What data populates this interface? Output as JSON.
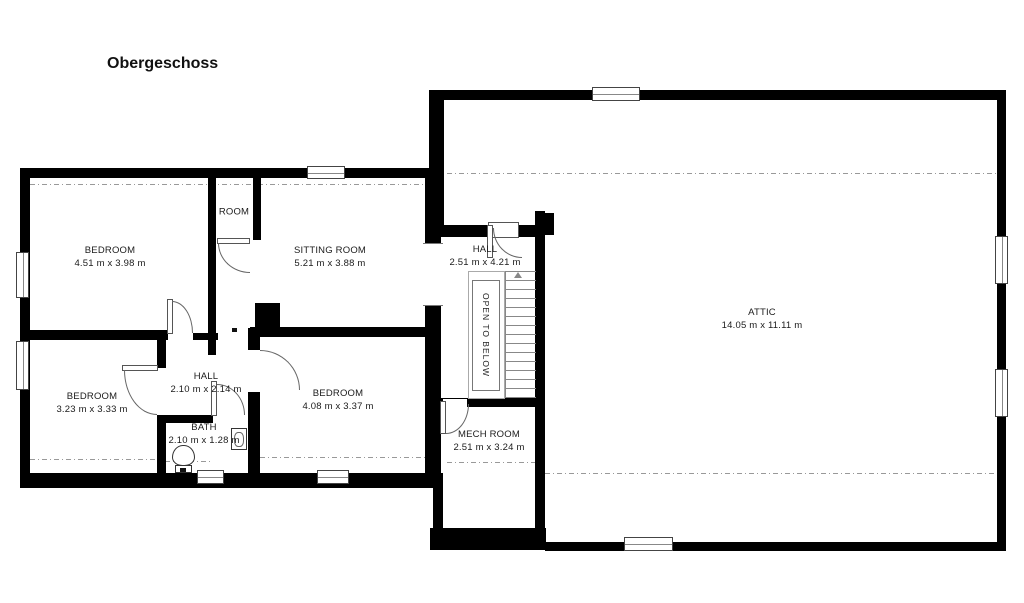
{
  "title": "Obergeschoss",
  "rooms": [
    {
      "id": "bedroom-1",
      "name": "BEDROOM",
      "dims": "4.51 m x 3.98 m"
    },
    {
      "id": "closet-room",
      "name": "ROOM",
      "dims": ""
    },
    {
      "id": "sitting-room",
      "name": "SITTING ROOM",
      "dims": "5.21 m x 3.88 m"
    },
    {
      "id": "hall-upper",
      "name": "HALL",
      "dims": "2.51 m x 4.21 m"
    },
    {
      "id": "attic",
      "name": "ATTIC",
      "dims": "14.05 m x 11.11 m"
    },
    {
      "id": "bedroom-2",
      "name": "BEDROOM",
      "dims": "3.23 m x 3.33 m"
    },
    {
      "id": "hall-lower",
      "name": "HALL",
      "dims": "2.10 m x 2.14 m"
    },
    {
      "id": "bedroom-3",
      "name": "BEDROOM",
      "dims": "4.08 m x 3.37 m"
    },
    {
      "id": "bath",
      "name": "BATH",
      "dims": "2.10 m x 1.28 m"
    },
    {
      "id": "mech-room",
      "name": "MECH ROOM",
      "dims": "2.51 m x 3.24 m"
    }
  ],
  "annotations": {
    "stairwell": "OPEN TO BELOW"
  },
  "colors": {
    "wall": "#000000",
    "line": "#666666",
    "dash": "#999999",
    "text": "#1b1b1b",
    "background": "#ffffff"
  }
}
